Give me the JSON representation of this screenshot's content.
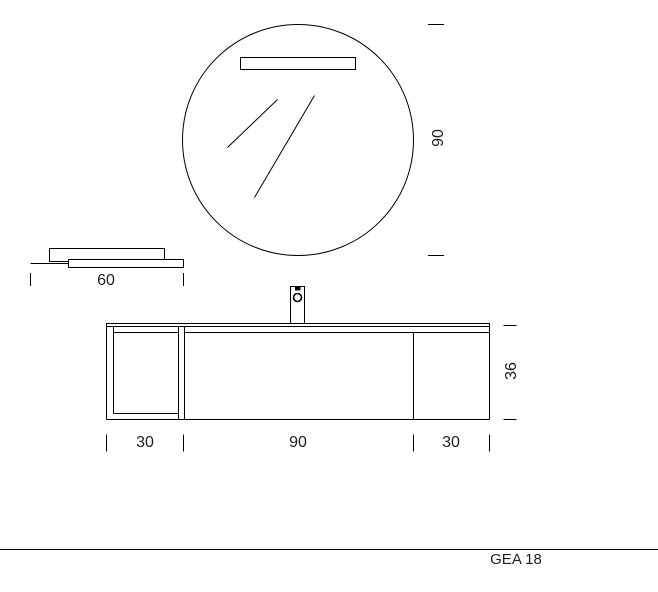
{
  "title_block": {
    "model": "GEA 18"
  },
  "dimensions": {
    "mirror_diameter": "90",
    "shelf_width": "60",
    "vanity_height": "36",
    "vanity_widths": [
      {
        "label": "30"
      },
      {
        "label": "90"
      },
      {
        "label": "30"
      }
    ]
  },
  "colors": {
    "line": "#000000",
    "text": "#1f1f1f",
    "background": "#ffffff"
  }
}
